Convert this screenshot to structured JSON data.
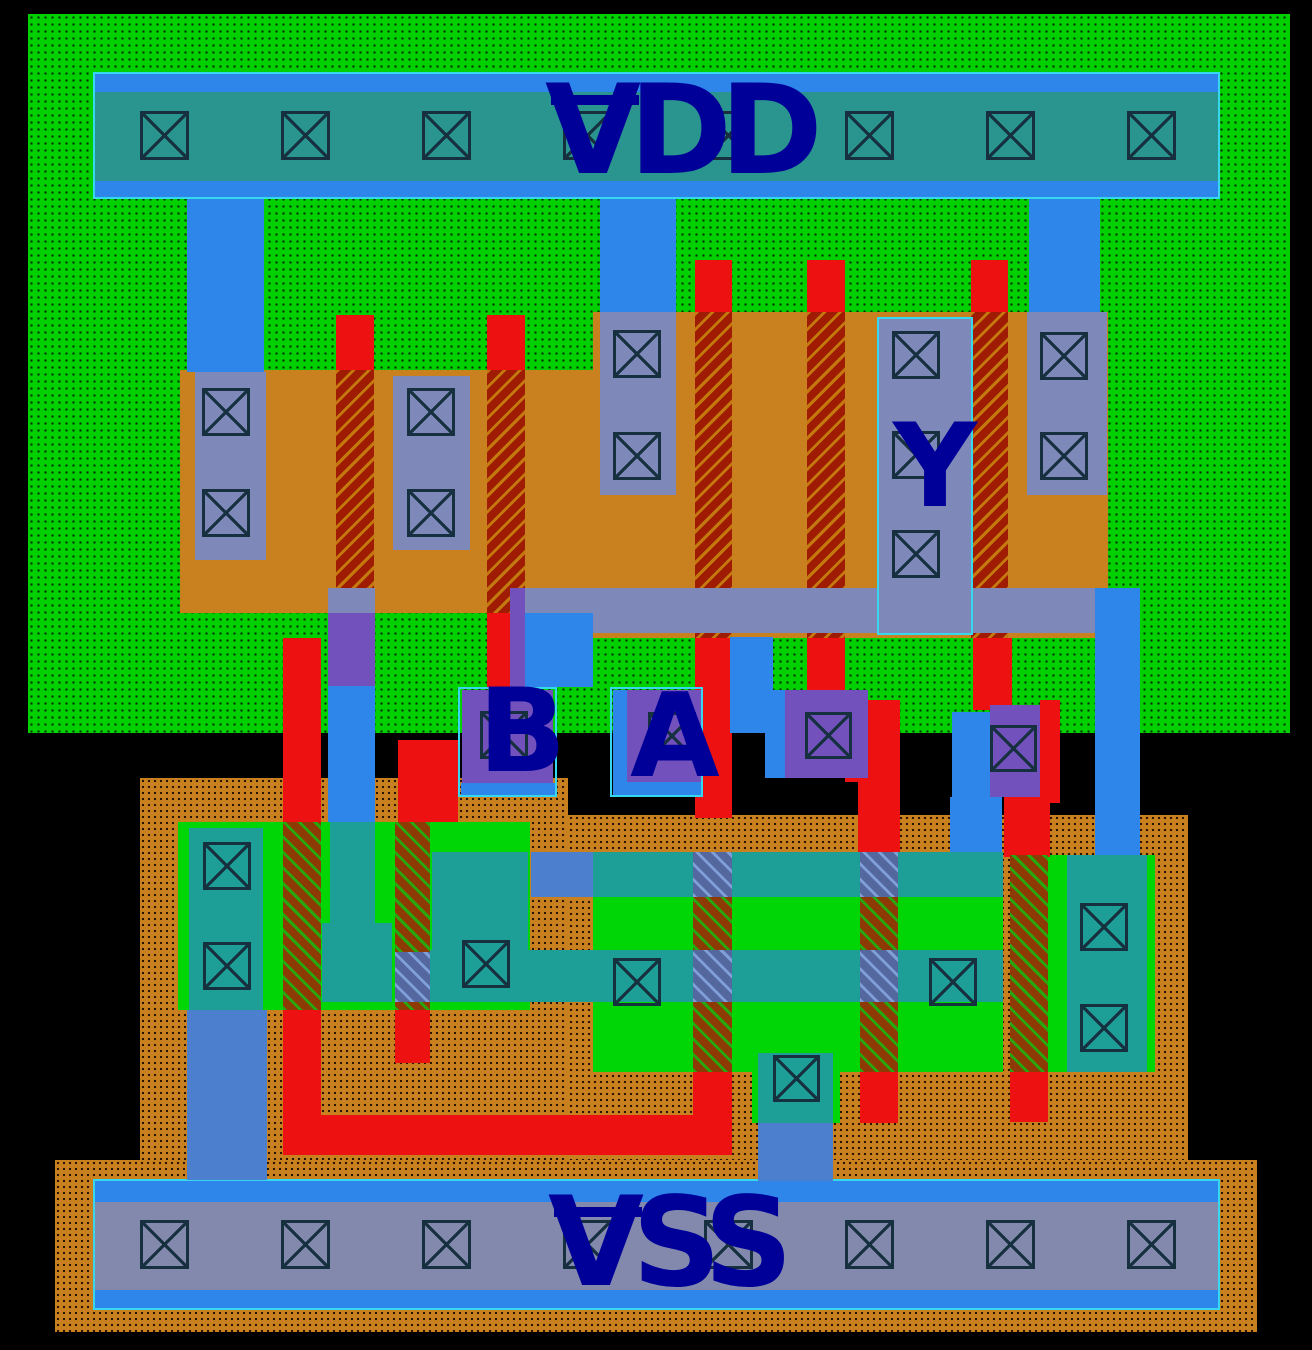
{
  "labels": {
    "vdd": "VDD",
    "vss": "VSS",
    "a": "A",
    "b": "B",
    "y": "Y"
  },
  "colors": {
    "bg": "#000000",
    "nwell": "#00cf00",
    "well-dot": "#063006",
    "pwell": "#c9801f",
    "well-dot2": "#2a1502",
    "pdiff": "#c9801f",
    "ndiff": "#00d606",
    "poly": "#ee1111",
    "gate-p-dark": "#9f1c02",
    "gate-p-stripe": "#c4790f",
    "gate-n-dark": "#8d3a04",
    "gate-n-stripe": "#27a80e",
    "band-base": "#55679f",
    "band-stripe": "#7f9fd9",
    "metal-slate": "#7e89ba",
    "metal-teal": "#1d9e96",
    "metal-blue": "#2e86ea",
    "metal-muted": "#4c80cf",
    "metal-purple": "#7251bc",
    "vdd-inner": "#2a958f",
    "vss-inner": "#8289ad",
    "pin-border": "#35d8ee",
    "contact-line": "#16303f",
    "label": "#000099"
  },
  "rects": [
    {
      "n": "nwell-region",
      "c": "wn",
      "x": 28,
      "y": 14,
      "w": 1262,
      "h": 719
    },
    {
      "n": "pwell-region-left",
      "c": "wp",
      "x": 140,
      "y": 778,
      "w": 428,
      "h": 382
    },
    {
      "n": "pwell-region-right",
      "c": "wp",
      "x": 568,
      "y": 815,
      "w": 620,
      "h": 345
    },
    {
      "n": "pwell-region-bottom",
      "c": "wp",
      "x": 55,
      "y": 1160,
      "w": 1202,
      "h": 172
    },
    {
      "n": "pdiff-left",
      "c": "dp",
      "x": 180,
      "y": 370,
      "w": 413,
      "h": 243
    },
    {
      "n": "pdiff-main",
      "c": "dp",
      "x": 593,
      "y": 312,
      "w": 515,
      "h": 326
    },
    {
      "n": "ndiff-left",
      "c": "dn",
      "x": 178,
      "y": 822,
      "w": 352,
      "h": 188
    },
    {
      "n": "ndiff-main",
      "c": "dn",
      "x": 593,
      "y": 852,
      "w": 410,
      "h": 220
    },
    {
      "n": "ndiff-right",
      "c": "dn",
      "x": 1048,
      "y": 855,
      "w": 107,
      "h": 217
    },
    {
      "n": "ndiff-center-tab",
      "c": "dn",
      "x": 752,
      "y": 1072,
      "w": 88,
      "h": 51
    },
    {
      "n": "poly1-top",
      "c": "po",
      "x": 336,
      "y": 315,
      "w": 38,
      "h": 57
    },
    {
      "n": "poly2-top",
      "c": "po",
      "x": 487,
      "y": 315,
      "w": 38,
      "h": 57
    },
    {
      "n": "poly3-top",
      "c": "po",
      "x": 695,
      "y": 260,
      "w": 37,
      "h": 54
    },
    {
      "n": "poly4-top",
      "c": "po",
      "x": 807,
      "y": 260,
      "w": 38,
      "h": 54
    },
    {
      "n": "poly5-top",
      "c": "po",
      "x": 971,
      "y": 260,
      "w": 37,
      "h": 54
    },
    {
      "n": "pmos-gate-1",
      "c": "gp",
      "x": 336,
      "y": 370,
      "w": 38,
      "h": 243
    },
    {
      "n": "pmos-gate-2",
      "c": "gp",
      "x": 487,
      "y": 370,
      "w": 38,
      "h": 243
    },
    {
      "n": "pmos-gate-3",
      "c": "gp",
      "x": 695,
      "y": 312,
      "w": 37,
      "h": 326
    },
    {
      "n": "pmos-gate-4",
      "c": "gp",
      "x": 807,
      "y": 312,
      "w": 38,
      "h": 326
    },
    {
      "n": "pmos-gate-5",
      "c": "gp",
      "x": 971,
      "y": 312,
      "w": 37,
      "h": 326
    },
    {
      "n": "poly2-stub",
      "c": "po",
      "x": 487,
      "y": 613,
      "w": 24,
      "h": 75
    },
    {
      "n": "poly3-mid",
      "c": "po",
      "x": 695,
      "y": 638,
      "w": 37,
      "h": 180
    },
    {
      "n": "poly4-mid",
      "c": "po",
      "x": 807,
      "y": 638,
      "w": 38,
      "h": 65
    },
    {
      "n": "poly4-jog",
      "c": "po",
      "x": 845,
      "y": 700,
      "w": 55,
      "h": 82
    },
    {
      "n": "poly4-down",
      "c": "po",
      "x": 858,
      "y": 778,
      "w": 42,
      "h": 76
    },
    {
      "n": "poly5-mid",
      "c": "po",
      "x": 973,
      "y": 638,
      "w": 39,
      "h": 72
    },
    {
      "n": "poly5-right",
      "c": "po",
      "x": 1040,
      "y": 700,
      "w": 20,
      "h": 103
    },
    {
      "n": "poly5-down",
      "c": "po",
      "x": 1004,
      "y": 787,
      "w": 46,
      "h": 70
    },
    {
      "n": "polyB-left",
      "c": "po",
      "x": 283,
      "y": 638,
      "w": 38,
      "h": 184
    },
    {
      "n": "polyB-stub",
      "c": "po",
      "x": 398,
      "y": 740,
      "w": 60,
      "h": 82
    },
    {
      "n": "nmos-gate-1",
      "c": "gn",
      "x": 283,
      "y": 822,
      "w": 38,
      "h": 188
    },
    {
      "n": "nmos-gate-2",
      "c": "gn",
      "x": 395,
      "y": 822,
      "w": 35,
      "h": 188
    },
    {
      "n": "nmos-gate-3",
      "c": "gn",
      "x": 693,
      "y": 852,
      "w": 39,
      "h": 220
    },
    {
      "n": "nmos-gate-4",
      "c": "gn",
      "x": 860,
      "y": 852,
      "w": 38,
      "h": 220
    },
    {
      "n": "nmos-gate-5",
      "c": "gn",
      "x": 1010,
      "y": 855,
      "w": 38,
      "h": 217
    },
    {
      "n": "polyB-left-low",
      "c": "po",
      "x": 283,
      "y": 1010,
      "w": 38,
      "h": 110
    },
    {
      "n": "polyB2-low",
      "c": "po",
      "x": 395,
      "y": 1010,
      "w": 35,
      "h": 53
    },
    {
      "n": "poly3-low",
      "c": "po",
      "x": 693,
      "y": 1072,
      "w": 39,
      "h": 47
    },
    {
      "n": "poly4-low",
      "c": "po",
      "x": 860,
      "y": 1072,
      "w": 38,
      "h": 51
    },
    {
      "n": "poly5-low",
      "c": "po",
      "x": 1010,
      "y": 1072,
      "w": 38,
      "h": 50
    },
    {
      "n": "poly-bottom-bar",
      "c": "po",
      "x": 283,
      "y": 1115,
      "w": 449,
      "h": 40
    },
    {
      "n": "vdd-rail",
      "c": "rail",
      "x": 93,
      "y": 72,
      "w": 1127,
      "h": 127
    },
    {
      "n": "vdd-rail-tap-band",
      "c": "tin",
      "x": 95,
      "y": 92,
      "w": 1123,
      "h": 89
    },
    {
      "n": "vss-rail",
      "c": "rail",
      "x": 93,
      "y": 1179,
      "w": 1127,
      "h": 131
    },
    {
      "n": "vss-rail-tap-band",
      "c": "sin",
      "x": 95,
      "y": 1202,
      "w": 1123,
      "h": 88
    },
    {
      "n": "vdd-strap-left",
      "c": "mb",
      "x": 187,
      "y": 199,
      "w": 77,
      "h": 173
    },
    {
      "n": "vdd-strap-mid",
      "c": "mb",
      "x": 600,
      "y": 199,
      "w": 76,
      "h": 114
    },
    {
      "n": "vdd-strap-right",
      "c": "mb",
      "x": 1029,
      "y": 199,
      "w": 71,
      "h": 114
    },
    {
      "n": "sd-contact-strip-1",
      "c": "ms",
      "x": 195,
      "y": 372,
      "w": 71,
      "h": 188
    },
    {
      "n": "sd-contact-strip-2",
      "c": "ms",
      "x": 393,
      "y": 376,
      "w": 77,
      "h": 174
    },
    {
      "n": "sd-contact-strip-3",
      "c": "ms",
      "x": 600,
      "y": 312,
      "w": 76,
      "h": 183
    },
    {
      "n": "sd-contact-strip-5",
      "c": "ms",
      "x": 1027,
      "y": 312,
      "w": 80,
      "h": 183
    },
    {
      "n": "output-mid-bar",
      "c": "ms",
      "x": 510,
      "y": 588,
      "w": 590,
      "h": 45
    },
    {
      "n": "output-mid-bar-left",
      "c": "ms",
      "x": 328,
      "y": 588,
      "w": 47,
      "h": 25
    },
    {
      "n": "y-contact-strip",
      "c": "ms",
      "x": 879,
      "y": 319,
      "w": 92,
      "h": 314
    },
    {
      "n": "bcol-over-poly",
      "c": "mp",
      "x": 328,
      "y": 613,
      "w": 47,
      "h": 73
    },
    {
      "n": "bcol-metal",
      "c": "mb",
      "x": 328,
      "y": 686,
      "w": 47,
      "h": 136
    },
    {
      "n": "bcol-drain-metal",
      "c": "mt",
      "x": 330,
      "y": 822,
      "w": 45,
      "h": 110
    },
    {
      "n": "nmos-teal-3",
      "c": "mt",
      "x": 322,
      "y": 923,
      "w": 70,
      "h": 79
    },
    {
      "n": "midbar-b-link",
      "c": "mb",
      "x": 525,
      "y": 613,
      "w": 68,
      "h": 74
    },
    {
      "n": "midbar-b-link-poly",
      "c": "mp",
      "x": 510,
      "y": 588,
      "w": 15,
      "h": 99
    },
    {
      "n": "a-right-stub",
      "c": "mb",
      "x": 730,
      "y": 637,
      "w": 43,
      "h": 96
    },
    {
      "n": "y-output-strap",
      "c": "mb",
      "x": 1095,
      "y": 588,
      "w": 45,
      "h": 270
    },
    {
      "n": "contact3-metal-left",
      "c": "mb",
      "x": 765,
      "y": 690,
      "w": 20,
      "h": 88
    },
    {
      "n": "contact3-box",
      "c": "mp",
      "x": 785,
      "y": 690,
      "w": 83,
      "h": 88
    },
    {
      "n": "contact4-metal-left",
      "c": "mb",
      "x": 952,
      "y": 712,
      "w": 38,
      "h": 85
    },
    {
      "n": "contact4-box",
      "c": "mp",
      "x": 990,
      "y": 705,
      "w": 50,
      "h": 92
    },
    {
      "n": "contact4-strap",
      "c": "mb",
      "x": 950,
      "y": 797,
      "w": 52,
      "h": 57
    },
    {
      "n": "nmos-band1-left",
      "c": "mm",
      "x": 531,
      "y": 852,
      "w": 62,
      "h": 45
    },
    {
      "n": "nmos-band1-a",
      "c": "mt",
      "x": 593,
      "y": 852,
      "w": 100,
      "h": 45
    },
    {
      "n": "nmos-band1-x1",
      "c": "mbh",
      "x": 693,
      "y": 852,
      "w": 39,
      "h": 45
    },
    {
      "n": "nmos-band1-b",
      "c": "mt",
      "x": 732,
      "y": 852,
      "w": 128,
      "h": 45
    },
    {
      "n": "nmos-band1-x2",
      "c": "mbh",
      "x": 860,
      "y": 852,
      "w": 38,
      "h": 45
    },
    {
      "n": "nmos-band1-c",
      "c": "mt",
      "x": 898,
      "y": 852,
      "w": 105,
      "h": 45
    },
    {
      "n": "nmos-band2-x0",
      "c": "mbh",
      "x": 395,
      "y": 952,
      "w": 35,
      "h": 50
    },
    {
      "n": "nmos-band2-a",
      "c": "mt",
      "x": 430,
      "y": 950,
      "w": 263,
      "h": 52
    },
    {
      "n": "nmos-band2-x1",
      "c": "mbh",
      "x": 693,
      "y": 950,
      "w": 39,
      "h": 52
    },
    {
      "n": "nmos-band2-b",
      "c": "mt",
      "x": 732,
      "y": 950,
      "w": 128,
      "h": 52
    },
    {
      "n": "nmos-band2-x2",
      "c": "mbh",
      "x": 860,
      "y": 950,
      "w": 38,
      "h": 52
    },
    {
      "n": "nmos-band2-c",
      "c": "mt",
      "x": 898,
      "y": 950,
      "w": 105,
      "h": 52
    },
    {
      "n": "vss-tap-metal-left",
      "c": "mt",
      "x": 189,
      "y": 828,
      "w": 74,
      "h": 182
    },
    {
      "n": "nmos-teal-2",
      "c": "mt",
      "x": 432,
      "y": 852,
      "w": 96,
      "h": 148
    },
    {
      "n": "nmos-teal-right",
      "c": "mt",
      "x": 1067,
      "y": 855,
      "w": 80,
      "h": 217
    },
    {
      "n": "vss-tap-metal-center",
      "c": "mt",
      "x": 758,
      "y": 1053,
      "w": 75,
      "h": 70
    },
    {
      "n": "vss-strap-left",
      "c": "mm",
      "x": 187,
      "y": 1010,
      "w": 80,
      "h": 170
    },
    {
      "n": "vss-strap-center",
      "c": "mm",
      "x": 758,
      "y": 1123,
      "w": 75,
      "h": 58
    },
    {
      "n": "b-pin-purple",
      "c": "mp",
      "x": 462,
      "y": 690,
      "w": 91,
      "h": 93
    },
    {
      "n": "b-pin-metal",
      "c": "mb",
      "x": 461,
      "y": 783,
      "w": 94,
      "h": 13
    },
    {
      "n": "a-pin-metal-left",
      "c": "mb",
      "x": 613,
      "y": 690,
      "w": 14,
      "h": 105
    },
    {
      "n": "a-pin-purple",
      "c": "mp",
      "x": 627,
      "y": 690,
      "w": 75,
      "h": 92
    },
    {
      "n": "a-pin-metal-bottom",
      "c": "mb",
      "x": 627,
      "y": 782,
      "w": 75,
      "h": 14
    },
    {
      "n": "y-pin-box",
      "c": "pin",
      "x": 877,
      "y": 317,
      "w": 96,
      "h": 318
    },
    {
      "n": "b-pin-box",
      "c": "pin",
      "x": 458,
      "y": 687,
      "w": 99,
      "h": 110
    },
    {
      "n": "a-pin-box",
      "c": "pin",
      "x": 610,
      "y": 687,
      "w": 93,
      "h": 110
    }
  ],
  "contacts": [
    {
      "x": 140,
      "y": 111,
      "s": 49
    },
    {
      "x": 281,
      "y": 111,
      "s": 49
    },
    {
      "x": 422,
      "y": 111,
      "s": 49
    },
    {
      "x": 563,
      "y": 111,
      "s": 49
    },
    {
      "x": 704,
      "y": 111,
      "s": 49
    },
    {
      "x": 845,
      "y": 111,
      "s": 49
    },
    {
      "x": 986,
      "y": 111,
      "s": 49
    },
    {
      "x": 1127,
      "y": 111,
      "s": 49
    },
    {
      "x": 140,
      "y": 1220,
      "s": 49
    },
    {
      "x": 281,
      "y": 1220,
      "s": 49
    },
    {
      "x": 422,
      "y": 1220,
      "s": 49
    },
    {
      "x": 563,
      "y": 1220,
      "s": 49
    },
    {
      "x": 704,
      "y": 1220,
      "s": 49
    },
    {
      "x": 845,
      "y": 1220,
      "s": 49
    },
    {
      "x": 986,
      "y": 1220,
      "s": 49
    },
    {
      "x": 1127,
      "y": 1220,
      "s": 49
    },
    {
      "x": 202,
      "y": 388,
      "s": 48
    },
    {
      "x": 202,
      "y": 489,
      "s": 48
    },
    {
      "x": 407,
      "y": 388,
      "s": 48
    },
    {
      "x": 407,
      "y": 489,
      "s": 48
    },
    {
      "x": 613,
      "y": 330,
      "s": 48
    },
    {
      "x": 613,
      "y": 432,
      "s": 48
    },
    {
      "x": 892,
      "y": 331,
      "s": 48
    },
    {
      "x": 892,
      "y": 431,
      "s": 48
    },
    {
      "x": 892,
      "y": 530,
      "s": 48
    },
    {
      "x": 1040,
      "y": 332,
      "s": 48
    },
    {
      "x": 1040,
      "y": 432,
      "s": 48
    },
    {
      "x": 480,
      "y": 711,
      "s": 48
    },
    {
      "x": 648,
      "y": 712,
      "s": 48
    },
    {
      "x": 805,
      "y": 712,
      "s": 47
    },
    {
      "x": 990,
      "y": 725,
      "s": 47
    },
    {
      "x": 203,
      "y": 842,
      "s": 48
    },
    {
      "x": 203,
      "y": 942,
      "s": 48
    },
    {
      "x": 462,
      "y": 940,
      "s": 48
    },
    {
      "x": 613,
      "y": 958,
      "s": 48
    },
    {
      "x": 929,
      "y": 958,
      "s": 48
    },
    {
      "x": 1080,
      "y": 903,
      "s": 48
    },
    {
      "x": 1080,
      "y": 1004,
      "s": 48
    },
    {
      "x": 773,
      "y": 1055,
      "s": 47
    }
  ]
}
